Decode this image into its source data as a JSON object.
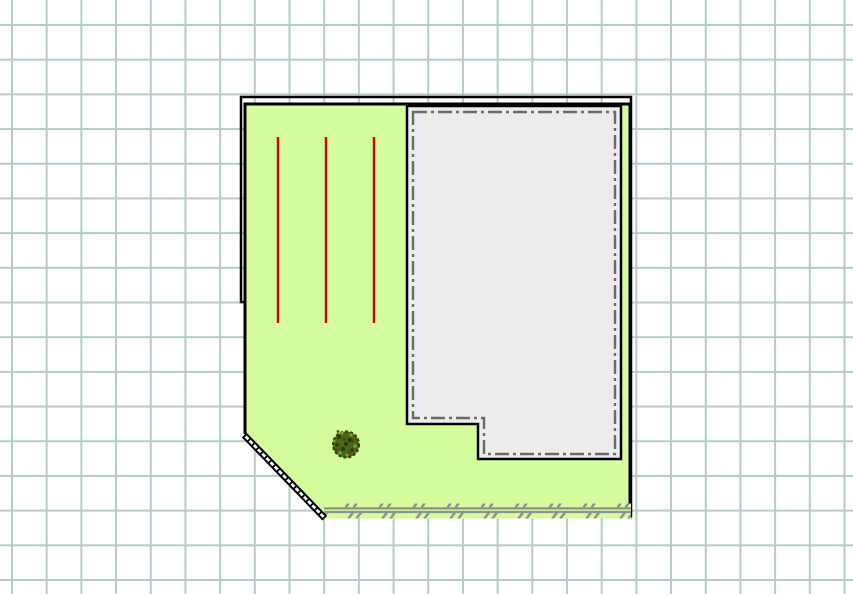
{
  "canvas": {
    "width_px": 853,
    "height_px": 594,
    "background": "#ffffff",
    "description": "garden / site plan drawing on squared grid paper, no visible text or toolbars"
  },
  "grid": {
    "spacing_px": 34.7,
    "offset_x_px": 11,
    "offset_y_px": 24,
    "line_width_px": 2,
    "color": "#b4cdbf"
  },
  "colors": {
    "outline": "#000000",
    "plot_fill": "#d5fd9e",
    "building_fill": "#ececec",
    "building_dashdot": "#6a6a6a",
    "planting_row_red": "#d40000",
    "hedge_gray": "#8f8f8f",
    "fence_band_white": "#ffffff",
    "shrub_base": "#4a661b",
    "shrub_edge": "#2f470e",
    "shrub_dark_speckle": "#243c06",
    "shrub_light_speckle": "#7fa23c",
    "shrub_brown_speckle": "#5d3f14"
  },
  "objects": {
    "plot": {
      "label": "garden plot",
      "shape": "rectangle with clipped south-west corner",
      "border": "solid black with offset outline along top and upper-left"
    },
    "building": {
      "label": "building footprint",
      "shape": "L-shaped (notch at bottom-left)",
      "border": "solid black with inner gray dash-dot line"
    },
    "planting_rows": {
      "label": "red planting row lines",
      "count": 3
    },
    "shrub": {
      "label": "round textured shrub symbol"
    },
    "hedge": {
      "label": "hedge strip along bottom edge of plot"
    },
    "fence": {
      "label": "double-line hatched fence on clipped corner"
    }
  }
}
